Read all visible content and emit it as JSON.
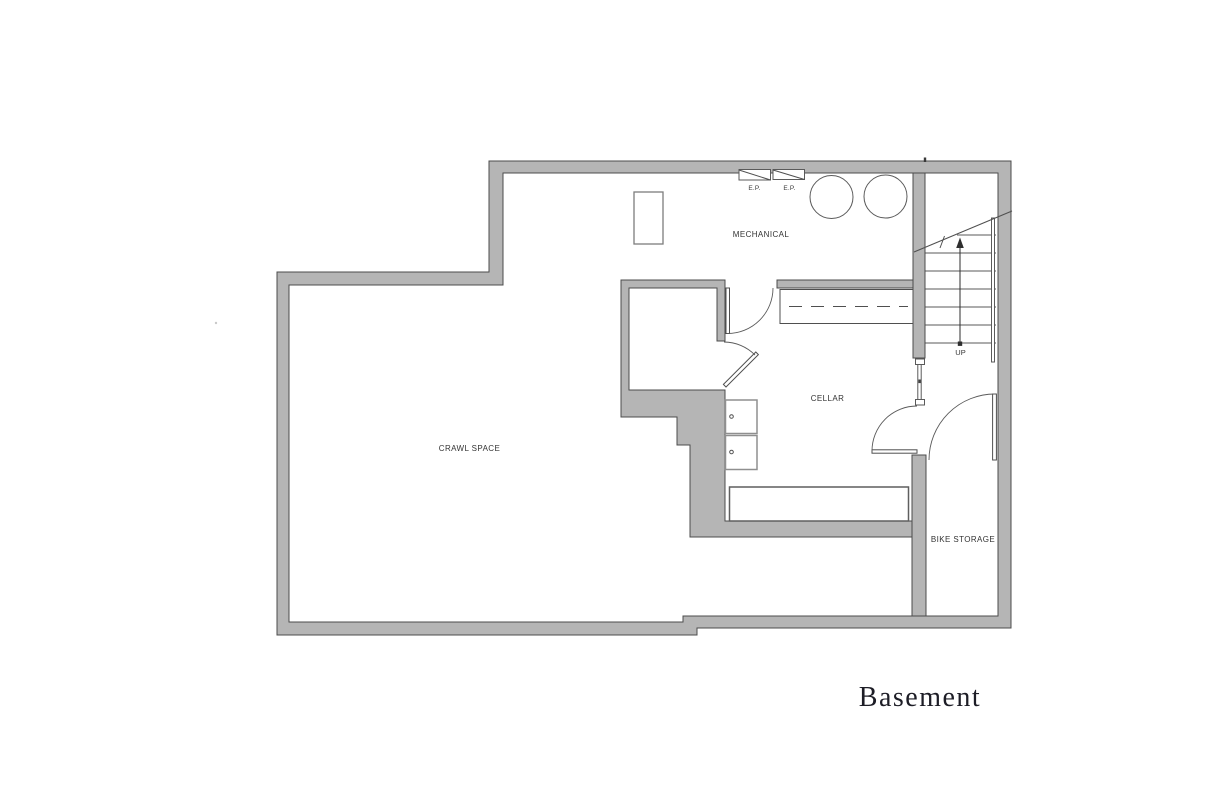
{
  "page": {
    "background": "#ffffff"
  },
  "plan": {
    "title": "Basement",
    "rooms": [
      {
        "label": "MECHANICAL"
      },
      {
        "label": "CELLAR"
      },
      {
        "label": "CRAWL SPACE"
      },
      {
        "label": "BIKE STORAGE"
      }
    ],
    "stairs": {
      "direction_label": "UP"
    },
    "equipment": {
      "electrical_panels": [
        {
          "label": "E.P."
        },
        {
          "label": "E.P."
        }
      ]
    },
    "colors": {
      "background": "#ffffff",
      "wall_fill": "#b5b5b5",
      "wall_outline": "#4c4c4c",
      "line": "#4f4f4f",
      "label_text": "#333333",
      "title_text": "#1d1d26"
    }
  }
}
